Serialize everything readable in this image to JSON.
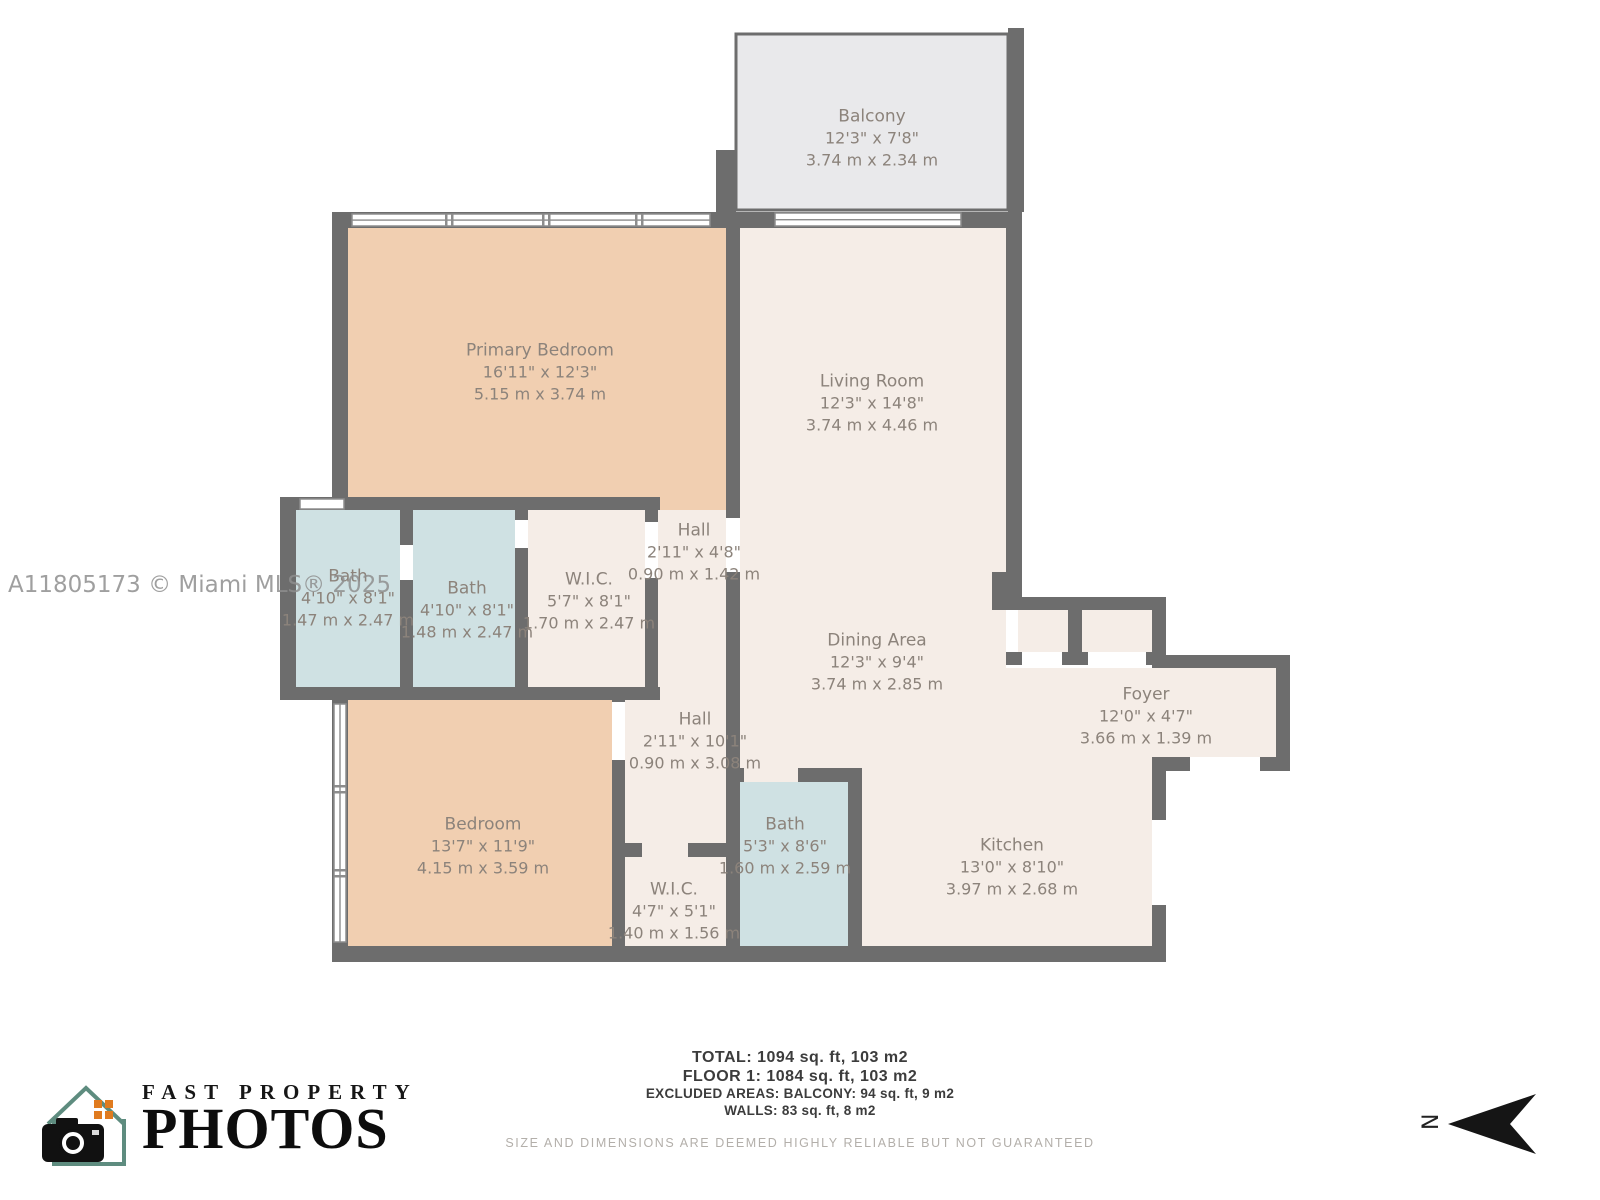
{
  "watermark": "A11805173 © Miami MLS® 2025",
  "rooms": [
    {
      "name": "Balcony",
      "imperial": "12'3\" x 7'8\"",
      "metric": "3.74 m x 2.34 m"
    },
    {
      "name": "Primary Bedroom",
      "imperial": "16'11\" x 12'3\"",
      "metric": "5.15 m x 3.74 m"
    },
    {
      "name": "Living Room",
      "imperial": "12'3\" x 14'8\"",
      "metric": "3.74 m x 4.46 m"
    },
    {
      "name": "Bath",
      "imperial": "4'10\" x 8'1\"",
      "metric": "1.47 m x 2.47 m"
    },
    {
      "name": "Bath",
      "imperial": "4'10\" x 8'1\"",
      "metric": "1.48 m x 2.47 m"
    },
    {
      "name": "W.I.C.",
      "imperial": "5'7\" x 8'1\"",
      "metric": "1.70 m x 2.47 m"
    },
    {
      "name": "Hall",
      "imperial": "2'11\" x 4'8\"",
      "metric": "0.90 m x 1.42 m"
    },
    {
      "name": "Dining Area",
      "imperial": "12'3\" x 9'4\"",
      "metric": "3.74 m x 2.85 m"
    },
    {
      "name": "Foyer",
      "imperial": "12'0\" x 4'7\"",
      "metric": "3.66 m x 1.39 m"
    },
    {
      "name": "Bedroom",
      "imperial": "13'7\" x 11'9\"",
      "metric": "4.15 m x 3.59 m"
    },
    {
      "name": "Hall",
      "imperial": "2'11\" x 10'1\"",
      "metric": "0.90 m x 3.08 m"
    },
    {
      "name": "Bath",
      "imperial": "5'3\" x 8'6\"",
      "metric": "1.60 m x 2.59 m"
    },
    {
      "name": "Kitchen",
      "imperial": "13'0\" x 8'10\"",
      "metric": "3.97 m x 2.68 m"
    },
    {
      "name": "W.I.C.",
      "imperial": "4'7\" x 5'1\"",
      "metric": "1.40 m x 1.56 m"
    }
  ],
  "summary": {
    "total": "TOTAL: 1094 sq. ft, 103 m2",
    "floor1": "FLOOR 1: 1084 sq. ft, 103 m2",
    "excluded": "EXCLUDED AREAS: BALCONY: 94 sq. ft, 9 m2",
    "walls": "WALLS: 83 sq. ft, 8 m2"
  },
  "disclaimer": "SIZE AND DIMENSIONS ARE DEEMED HIGHLY RELIABLE BUT NOT GUARANTEED",
  "logo": {
    "line1": "FAST PROPERTY",
    "line2": "PHOTOS"
  },
  "compass": {
    "label": "N"
  },
  "colors": {
    "wall": "#6d6d6d",
    "bedroom_fill": "#f1cfb1",
    "bath_fill": "#cfe1e3",
    "room_fill": "#f5ede7",
    "balcony_fill": "#e9e9eb",
    "label_text": "#8c837b"
  }
}
